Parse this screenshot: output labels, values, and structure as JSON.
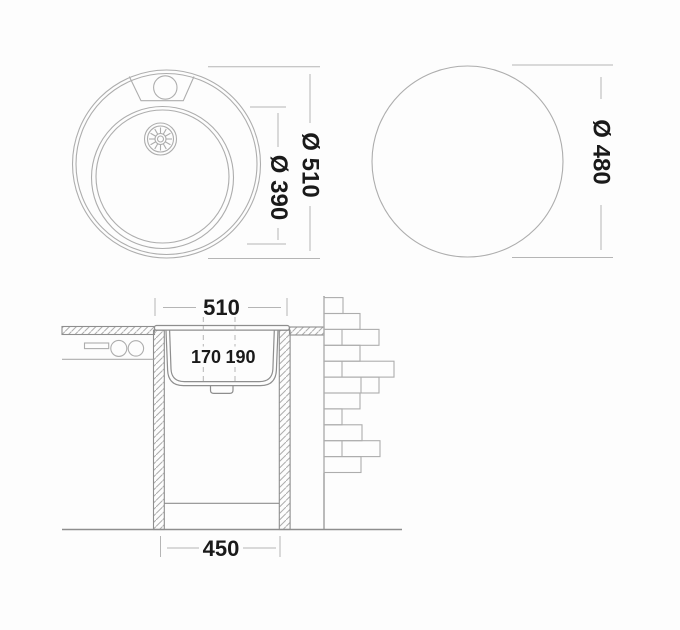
{
  "colors": {
    "bg": "#fdfdfd",
    "line-light": "#adadad",
    "line-mid": "#8e8e8e",
    "line-dim": "#b5b5b5",
    "text": "#1a1a1a"
  },
  "top_view": {
    "outer_diameter": "Ø 510",
    "bowl_diameter": "Ø 390"
  },
  "cutout_view": {
    "cutout_diameter": "Ø 480"
  },
  "section_view": {
    "overall_width": "510",
    "depth_left": "170",
    "depth_right": "190",
    "base_width": "450"
  }
}
